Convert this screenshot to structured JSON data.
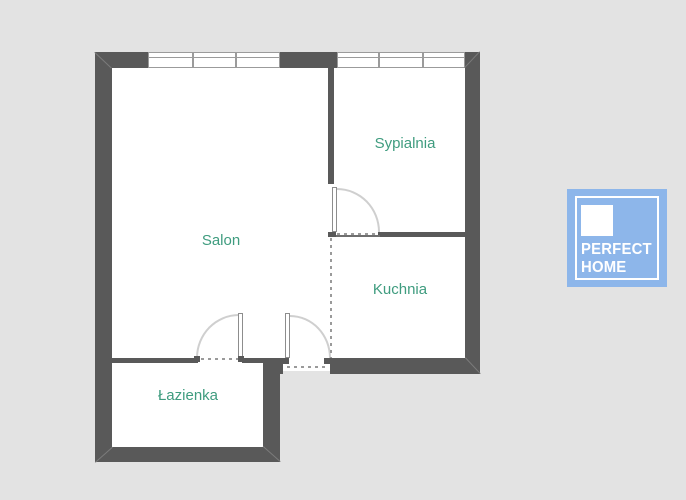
{
  "page": {
    "background": "#e3e3e3"
  },
  "floorplan": {
    "rooms": [
      {
        "name": "Salon"
      },
      {
        "name": "Sypialnia"
      },
      {
        "name": "Kuchnia"
      },
      {
        "name": "Łazienka"
      }
    ],
    "windows": [
      {
        "room": "Salon",
        "panes": 3,
        "wall": "top"
      },
      {
        "room": "Sypialnia",
        "panes": 3,
        "wall": "top"
      }
    ],
    "doors": [
      {
        "to": "Sypialnia",
        "swing": "into-bedroom"
      },
      {
        "to": "Łazienka",
        "swing": "into-salon"
      },
      {
        "type": "entrance",
        "swing": "into-salon"
      }
    ],
    "open_boundaries": [
      {
        "between": [
          "Salon",
          "Kuchnia"
        ],
        "style": "dashed"
      }
    ],
    "colors": {
      "wall": "#595959",
      "room_fill": "#ffffff",
      "label": "#3f9c7f",
      "door_arc": "#cfcfcf",
      "leaf_frame": "#8d8d8d",
      "dash": "#9a9a9a",
      "window_frame": "#9b9b9b"
    }
  },
  "logo": {
    "line1": "PERFECT",
    "line2": "HOME",
    "background": "#8db6ea",
    "text": "#ffffff"
  }
}
